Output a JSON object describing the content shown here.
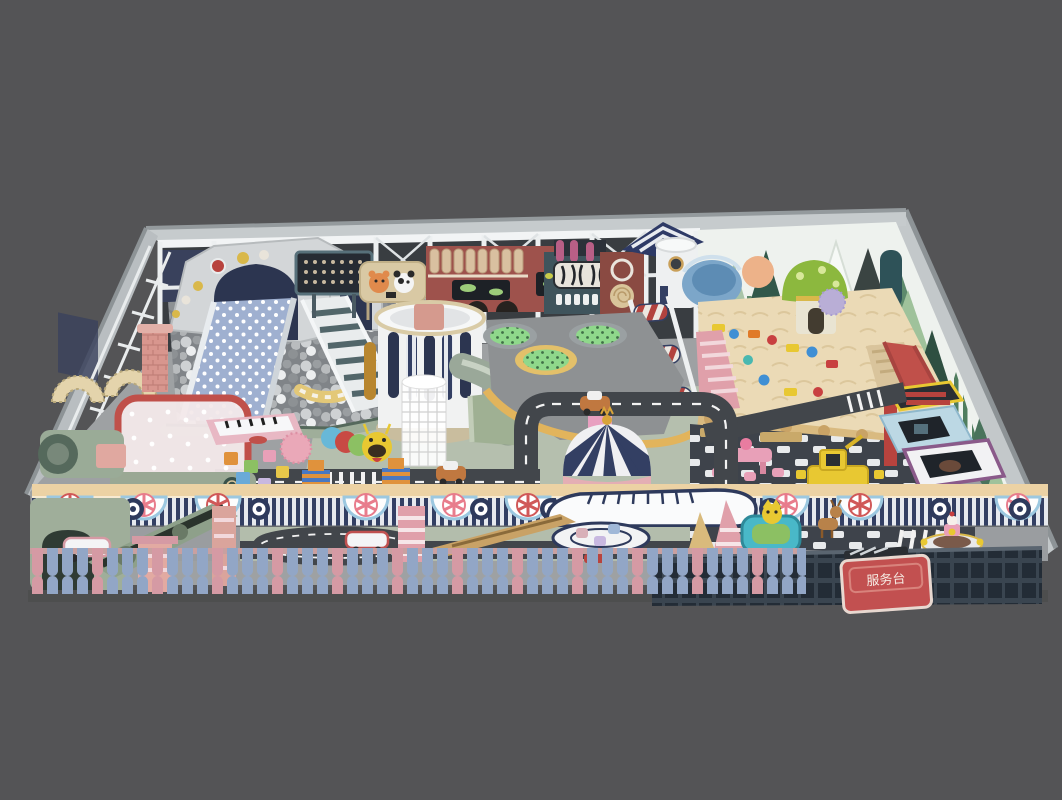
{
  "scene": {
    "type": "3d-architectural-render",
    "subject": "children indoor playground (soft play park) isometric overview",
    "background_color": "#545456",
    "sign_text": "服务台",
    "palette": {
      "wall_gray": "#c6cbcd",
      "interior_dark": "#393d41",
      "floor_gray": "#9ea1a3",
      "floor_sage": "#b5bfae",
      "sand": "#ebdab6",
      "road": "#42464b",
      "navy": "#333f63",
      "cream_band": "#ecd2a4",
      "brick_red": "#9e524c",
      "slide_blue": "#9fb0d0",
      "trampoline_green": "#8fd88b",
      "curb_yellow": "#e2b45c",
      "bowl_blue": "#7ca6c9",
      "fence_pink": "#d59aa4",
      "fence_blue": "#92a6c6",
      "sign_red": "#c25050"
    },
    "zones": [
      {
        "id": "ball-pit-slide",
        "label": "gray ball pit with polka-dot double slide and stairs"
      },
      {
        "id": "back-play-wall",
        "label": "white steel frame with billboards, brick playhouse, zebra panel"
      },
      {
        "id": "round-tower",
        "label": "white round tower with tube slide and spiral cage"
      },
      {
        "id": "trampoline-deck",
        "label": "platform with three green dotted trampolines"
      },
      {
        "id": "roller-ramp",
        "label": "red striped roller climb"
      },
      {
        "id": "sand-pit",
        "label": "sand pit with toys, mushroom house and red slide"
      },
      {
        "id": "checker-zone",
        "label": "checkered floor with pink table set, excavator ride and play rooms"
      },
      {
        "id": "road-circuit",
        "label": "toy car road loops with zebra crossings"
      },
      {
        "id": "dome-carousel",
        "label": "navy striped dome carousel"
      },
      {
        "id": "toddler-corner",
        "label": "red net ball cage, piano mat, foam blocks, caterpillar, block robots"
      },
      {
        "id": "front-wall",
        "label": "navy striped parade wall with scallops, pinwheels and whale arch"
      },
      {
        "id": "front-strip",
        "label": "front lane with ball machines, trains, mini carousel, rides, service desk"
      },
      {
        "id": "picket-fence",
        "label": "pink and blue picket fence"
      }
    ],
    "counts": {
      "trampolines": 3,
      "roller_segments": 3,
      "scallop_arches": 10,
      "tree_cutouts": 12
    }
  }
}
